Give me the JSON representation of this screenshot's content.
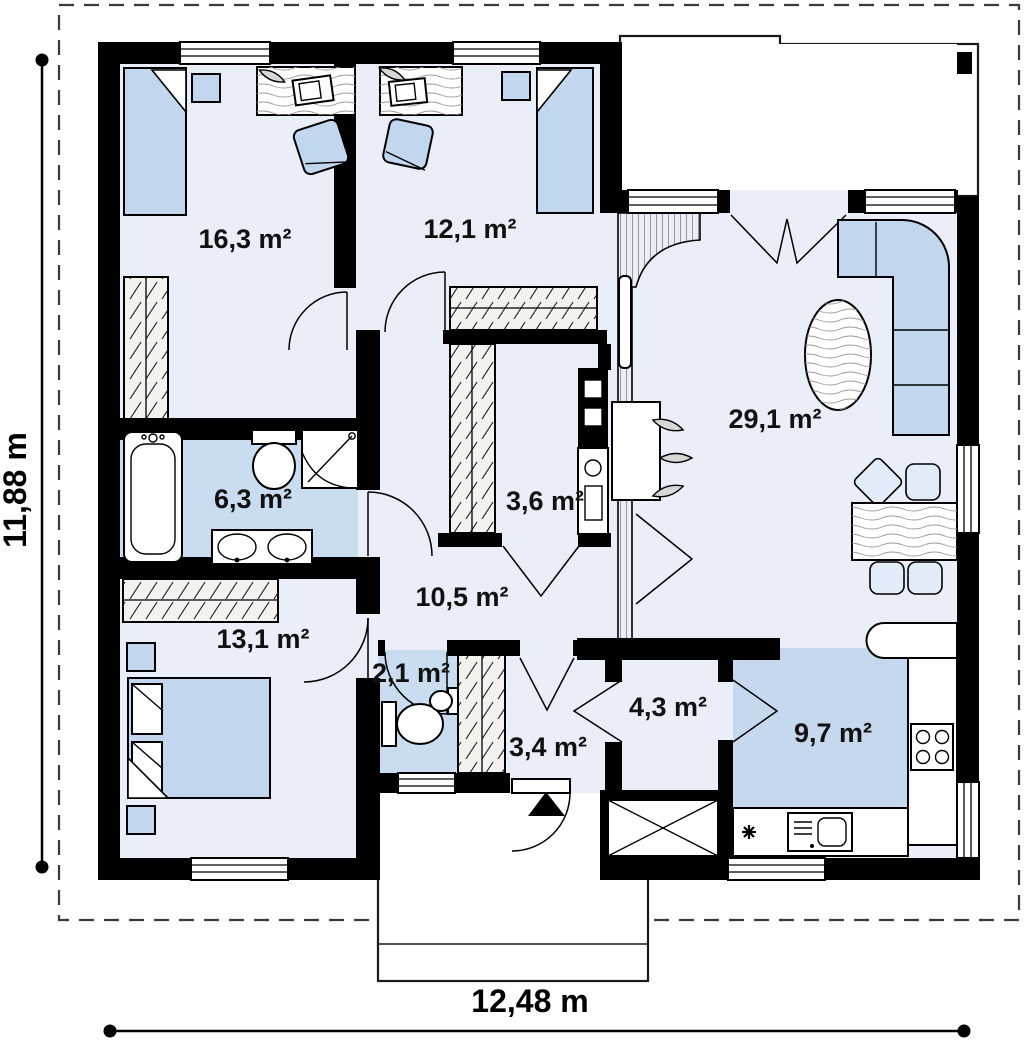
{
  "plan": {
    "dimension_labels": {
      "vertical": "11,88 m",
      "horizontal": "12,48 m"
    },
    "rooms": [
      {
        "key": "bedroom-1",
        "area_label": "16,3 m²"
      },
      {
        "key": "bedroom-2",
        "area_label": "12,1 m²"
      },
      {
        "key": "living-room",
        "area_label": "29,1 m²"
      },
      {
        "key": "bathroom",
        "area_label": "6,3 m²"
      },
      {
        "key": "closet-room",
        "area_label": "3,6 m²"
      },
      {
        "key": "hall",
        "area_label": "10,5 m²"
      },
      {
        "key": "bedroom-3",
        "area_label": "13,1 m²"
      },
      {
        "key": "toilet",
        "area_label": "2,1 m²"
      },
      {
        "key": "entry",
        "area_label": "3,4 m²"
      },
      {
        "key": "pantry",
        "area_label": "4,3 m²"
      },
      {
        "key": "kitchen",
        "area_label": "9,7 m²"
      }
    ],
    "colors": {
      "walls": "#000000",
      "room_floor": "#e9eef8",
      "wet_room_floor": "#c9dcf0",
      "kitchen_floor": "#c5d8ee",
      "furniture": "#c2d6ee",
      "background": "#ffffff"
    }
  }
}
